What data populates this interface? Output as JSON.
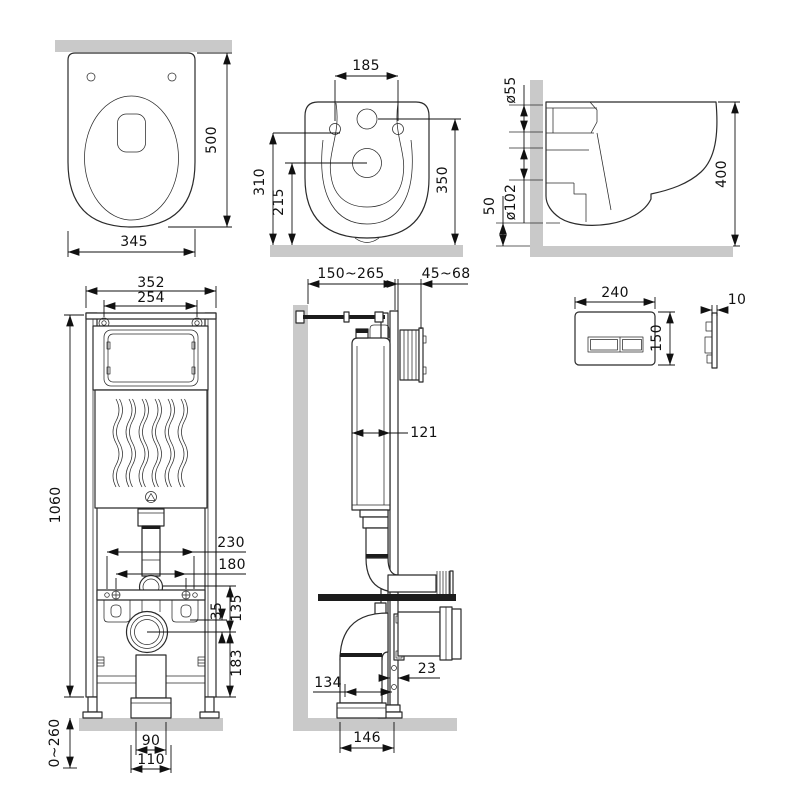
{
  "colors": {
    "wall_fill": "#c9c9c9",
    "line": "#2b2b2b",
    "text": "#111111"
  },
  "pan_top": {
    "depth": "500",
    "width": "345"
  },
  "pan_rear": {
    "bolt_spacing": "185",
    "trap_height": "310",
    "outlet_height": "215",
    "inlet_height": "350"
  },
  "pan_side": {
    "inlet_diameter": "ø55",
    "outlet_diameter": "ø102",
    "clearance": "50",
    "depth": "400"
  },
  "frame_front": {
    "frame_width": "352",
    "top_bolt_spacing": "254",
    "frame_height": "1060",
    "stud_spacing_outer": "230",
    "stud_spacing_inner": "180",
    "flush_to_outlet": "135",
    "bracket_to_outlet": "35",
    "outlet_to_bottom": "183",
    "foot_adjust": "0~260",
    "outlet_pipe": "90",
    "outlet_base": "110"
  },
  "frame_side": {
    "frame_depth_range": "150~265",
    "plate_depth_range": "45~68",
    "tank_depth": "121",
    "rail_depth": "23",
    "pipe_offset": "134",
    "base_depth": "146"
  },
  "flush_plate": {
    "width": "240",
    "height": "150",
    "thickness": "10"
  }
}
